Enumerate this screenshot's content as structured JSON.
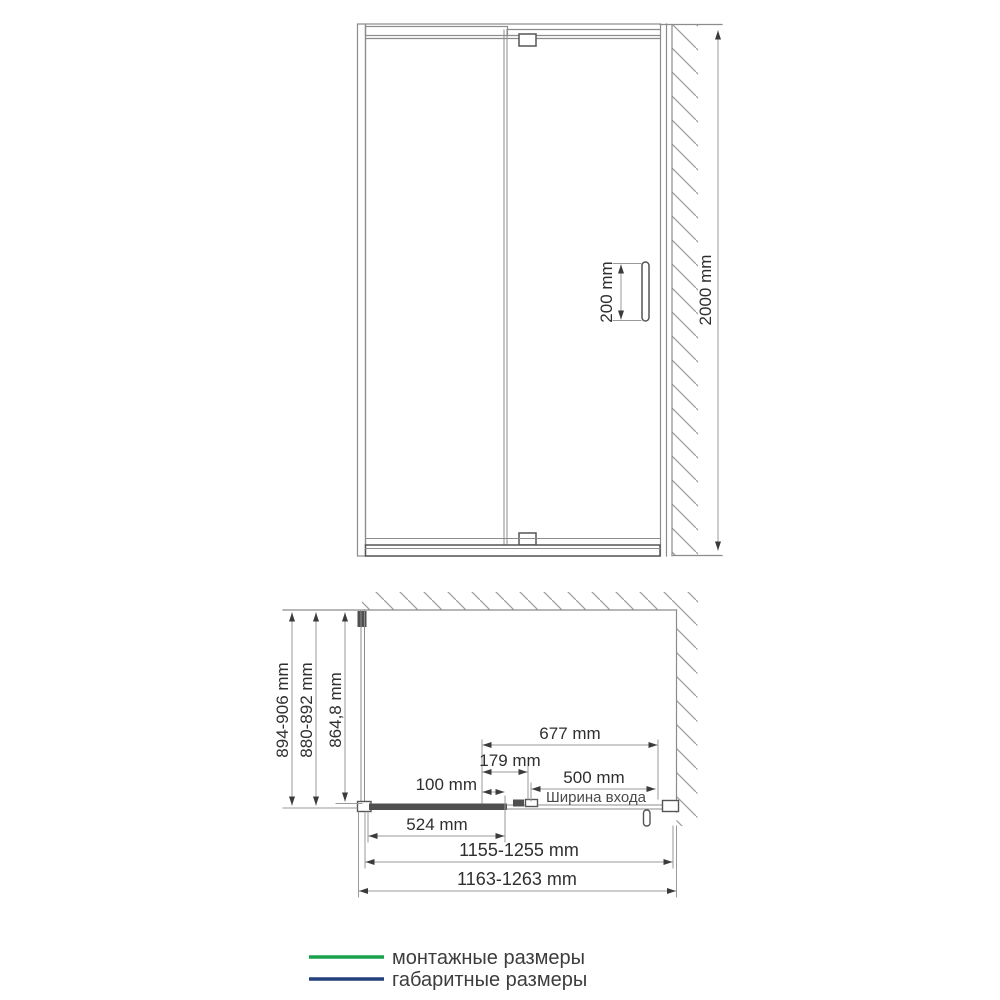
{
  "front_view": {
    "handle_length": "200 mm",
    "height": "2000 mm"
  },
  "plan_view": {
    "overall_depth": "894-906 mm",
    "mounting_depth": "880-892 mm",
    "inner_depth": "864,8 mm",
    "door_width": "677 mm",
    "overlap_width": "179 mm",
    "adjust_width": "100 mm",
    "entrance_width": "500 mm",
    "entrance_caption": "Ширина входа",
    "fixed_panel_width": "524 mm",
    "mounting_width": "1155-1255 mm",
    "overall_width": "1163-1263 mm"
  },
  "legend": {
    "mounting": {
      "label": "монтажные размеры",
      "color": "#1aa24b"
    },
    "overall": {
      "label": "габаритные размеры",
      "color": "#24407d"
    }
  },
  "colors": {
    "mounting": "#1aa24b",
    "overall": "#24407d",
    "ink": "#2f2f2f"
  }
}
